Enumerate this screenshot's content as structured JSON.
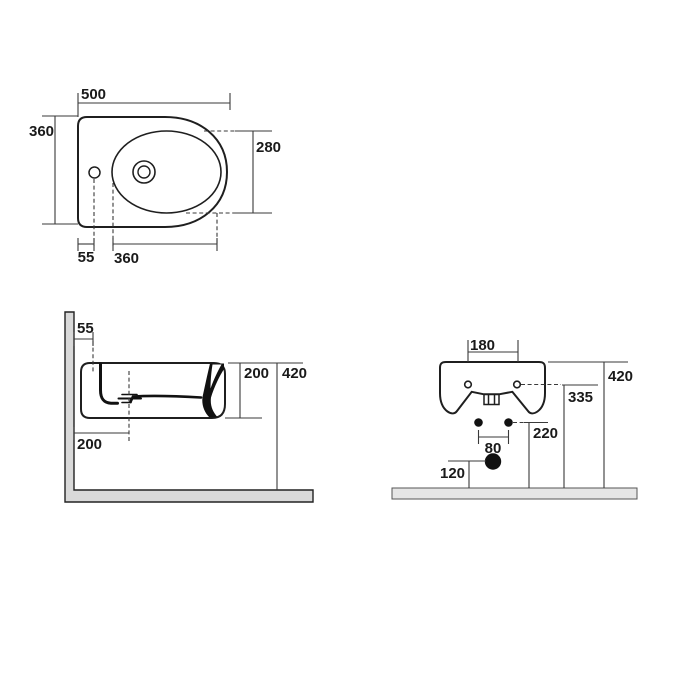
{
  "drawing": {
    "type": "technical-drawing",
    "subject": "wall-hung bidet installation dimensions",
    "units": "mm",
    "colors": {
      "background": "#ffffff",
      "line": "#1f1f1f",
      "dim_line": "#3a3a3a",
      "text": "#1a1a1a",
      "wall_fill": "#d9d9d9",
      "floor_fill": "#e6e6e6"
    },
    "views": {
      "top": {
        "name": "plan view",
        "dims": {
          "overall_width": "500",
          "overall_depth": "360",
          "tap_hole_offset": "55",
          "bowl_length": "360",
          "bowl_width": "280"
        }
      },
      "side": {
        "name": "side elevation",
        "dims": {
          "tap_hole_from_wall": "55",
          "drain_from_wall": "200",
          "body_height": "200",
          "rim_height": "420"
        }
      },
      "rear": {
        "name": "rear elevation",
        "dims": {
          "fixing_holes_spacing": "180",
          "rim_height": "420",
          "fixing_holes_height": "335",
          "water_inlets_height": "220",
          "water_inlets_spacing": "80",
          "waste_outlet_height": "120"
        }
      }
    }
  }
}
